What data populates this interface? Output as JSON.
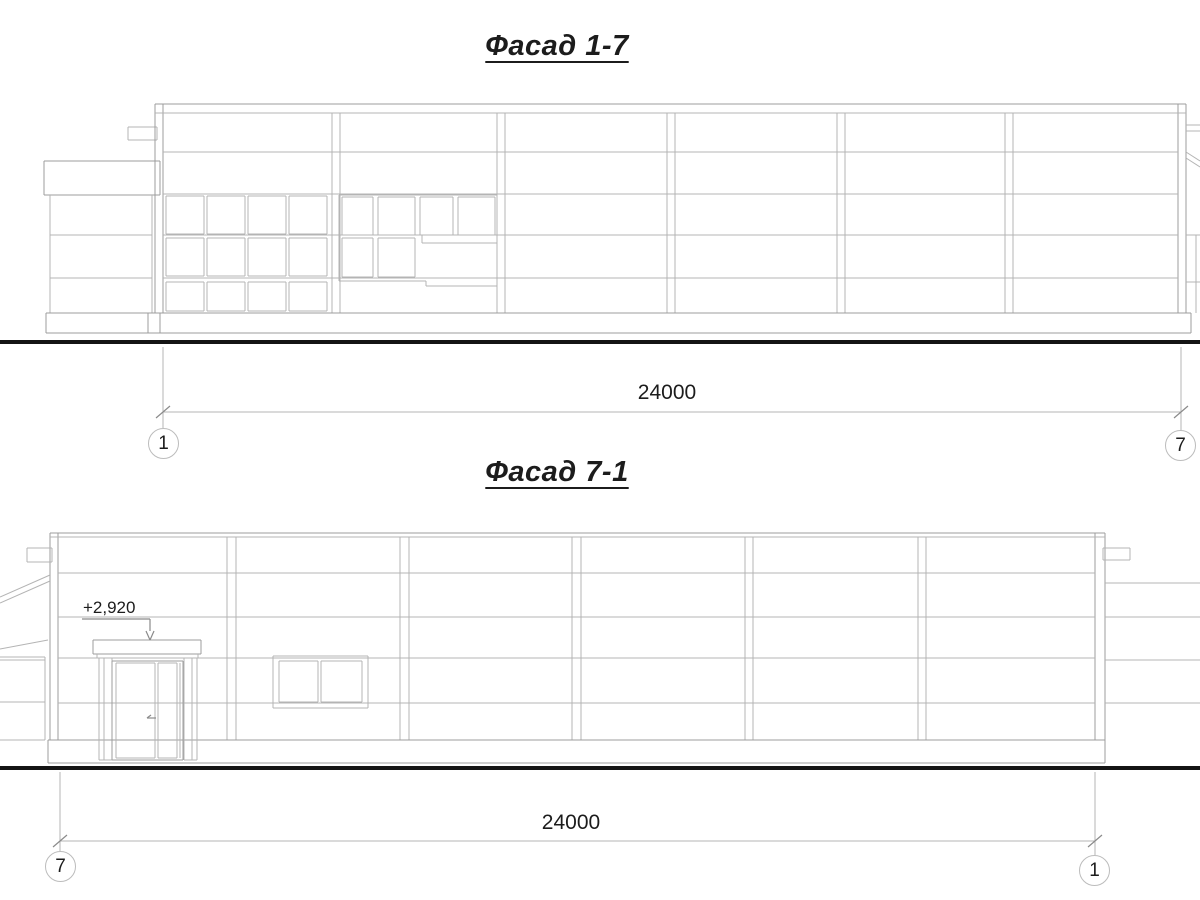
{
  "sheet": {
    "background": "#ffffff",
    "line_color": "#b4b4b4",
    "outline_color": "#9c9c9c",
    "ground_color": "#141414",
    "text_color": "#1c1c1c"
  },
  "facade_1_7": {
    "title": "Фасад 1-7",
    "dimension_label": "24000",
    "axis_left": "1",
    "axis_right": "7"
  },
  "facade_7_1": {
    "title": "Фасад 7-1",
    "dimension_label": "24000",
    "elevation_mark": "+2,920",
    "axis_left": "7",
    "axis_right": "1"
  }
}
